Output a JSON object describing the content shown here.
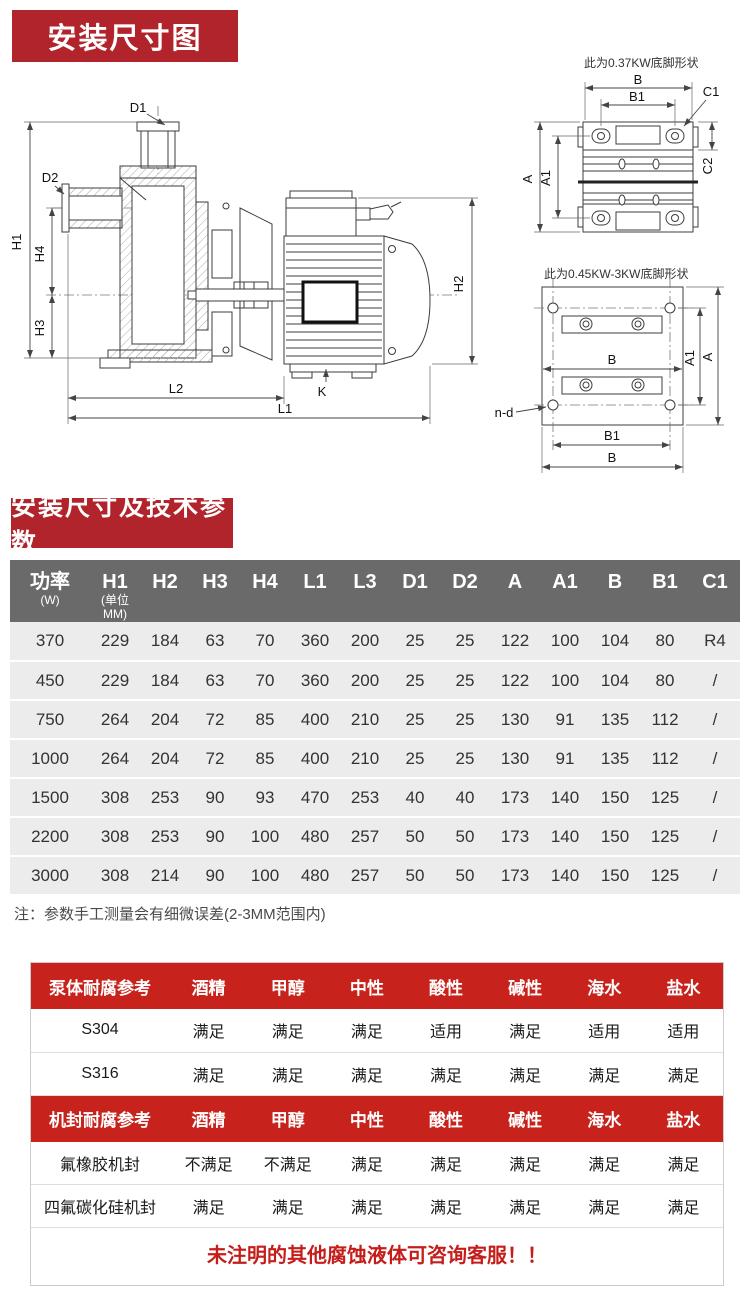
{
  "colors": {
    "badge_red": "#b1242b",
    "table_header_red": "#c7231c",
    "spec_header_gray": "#6b6a6a",
    "notice_red": "#c41d1a"
  },
  "section1": {
    "title": "安装尺寸图"
  },
  "section2": {
    "title": "安装尺寸及技术参数"
  },
  "diagram": {
    "caption_top_right": "此为0.37KW底脚形状",
    "caption_bottom_right": "此为0.45KW-3KW底脚形状",
    "labels": {
      "D1": "D1",
      "D2": "D2",
      "H1": "H1",
      "H2": "H2",
      "H3": "H3",
      "H4": "H4",
      "L1": "L1",
      "L2": "L2",
      "K": "K",
      "B_top": "B",
      "B1_top": "B1",
      "C1": "C1",
      "C2": "C2",
      "A_top": "A",
      "A1_top": "A1",
      "B_mid": "B",
      "B1_bottom": "B1",
      "B_bottom": "B",
      "A_right": "A",
      "A1_right": "A1",
      "n_d": "n-d"
    }
  },
  "spec_table": {
    "headers": [
      "功率",
      "H1",
      "H2",
      "H3",
      "H4",
      "L1",
      "L3",
      "D1",
      "D2",
      "A",
      "A1",
      "B",
      "B1",
      "C1"
    ],
    "subs": [
      "(W)",
      "(单位MM)",
      "",
      "",
      "",
      "",
      "",
      "",
      "",
      "",
      "",
      "",
      "",
      ""
    ],
    "rows": [
      [
        "370",
        "229",
        "184",
        "63",
        "70",
        "360",
        "200",
        "25",
        "25",
        "122",
        "100",
        "104",
        "80",
        "R4"
      ],
      [
        "450",
        "229",
        "184",
        "63",
        "70",
        "360",
        "200",
        "25",
        "25",
        "122",
        "100",
        "104",
        "80",
        "/"
      ],
      [
        "750",
        "264",
        "204",
        "72",
        "85",
        "400",
        "210",
        "25",
        "25",
        "130",
        "91",
        "135",
        "112",
        "/"
      ],
      [
        "1000",
        "264",
        "204",
        "72",
        "85",
        "400",
        "210",
        "25",
        "25",
        "130",
        "91",
        "135",
        "112",
        "/"
      ],
      [
        "1500",
        "308",
        "253",
        "90",
        "93",
        "470",
        "253",
        "40",
        "40",
        "173",
        "140",
        "150",
        "125",
        "/"
      ],
      [
        "2200",
        "308",
        "253",
        "90",
        "100",
        "480",
        "257",
        "50",
        "50",
        "173",
        "140",
        "150",
        "125",
        "/"
      ],
      [
        "3000",
        "308",
        "214",
        "90",
        "100",
        "480",
        "257",
        "50",
        "50",
        "173",
        "140",
        "150",
        "125",
        "/"
      ]
    ]
  },
  "note": "注：参数手工测量会有细微误差(2-3MM范围内)",
  "corrosion": {
    "pump_body": {
      "header": [
        "泵体耐腐参考",
        "酒精",
        "甲醇",
        "中性",
        "酸性",
        "碱性",
        "海水",
        "盐水"
      ],
      "rows": [
        [
          "S304",
          "满足",
          "满足",
          "满足",
          "适用",
          "满足",
          "适用",
          "适用"
        ],
        [
          "S316",
          "满足",
          "满足",
          "满足",
          "满足",
          "满足",
          "满足",
          "满足"
        ]
      ]
    },
    "seal": {
      "header": [
        "机封耐腐参考",
        "酒精",
        "甲醇",
        "中性",
        "酸性",
        "碱性",
        "海水",
        "盐水"
      ],
      "rows": [
        [
          "氟橡胶机封",
          "不满足",
          "不满足",
          "满足",
          "满足",
          "满足",
          "满足",
          "满足"
        ],
        [
          "四氟碳化硅机封",
          "满足",
          "满足",
          "满足",
          "满足",
          "满足",
          "满足",
          "满足"
        ]
      ]
    }
  },
  "footer": {
    "notice": "未注明的其他腐蚀液体可咨询客服！！"
  }
}
